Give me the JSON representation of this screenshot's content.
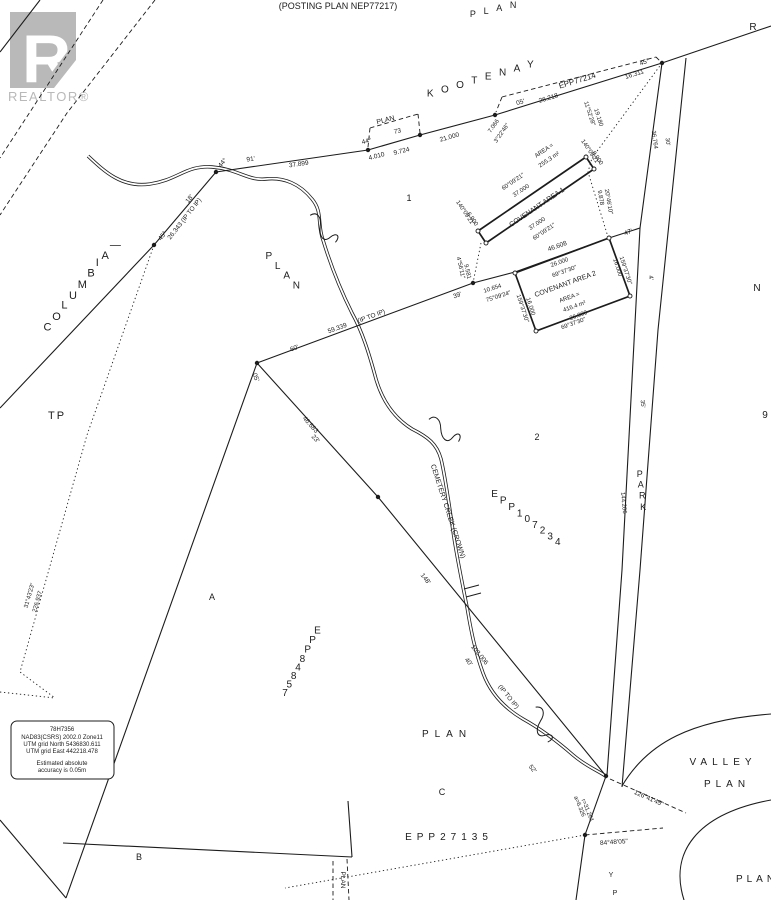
{
  "ink": "#1c1c1c",
  "watermark": {
    "r": "R",
    "brand": "REALTOR®",
    "gray": "#b9b9b9"
  },
  "header": {
    "posting_plan": "(POSTING PLAN NEP77217)",
    "plan": "PLAN"
  },
  "streets": {
    "kootenay": "KOOTENAY",
    "columbia": "COLUMBIA—",
    "park": "PARK",
    "valley": "VALLEY",
    "valley_plan": "PLAN",
    "street_letter_1": "Y",
    "street_letter_2": "P"
  },
  "plan_numbers": {
    "epp77214": "EPP77214",
    "epp107234": "EPP107234",
    "epp84857": "EPP84857",
    "epp27135": "EPP27135"
  },
  "lots": {
    "lot1": "1",
    "lot2": "2",
    "lotA": "A",
    "lotB": "B",
    "lotC": "C",
    "tp": "TP",
    "n": "N",
    "nine": "9",
    "r": "R",
    "plan_left": "PLAN",
    "plan_mid": "PLAN",
    "plan_strip": "PLAN",
    "plan_bottom_right": "PLAN"
  },
  "creek": {
    "name": "CEMETERY CREEK (CROWN)"
  },
  "covenant1": {
    "title": "COVENANT AREA 1",
    "area_label": "AREA =",
    "area_value": "255.3 m²"
  },
  "covenant2": {
    "title": "COVENANT AREA 2",
    "area_label": "AREA =",
    "area_value": "416.4 m²"
  },
  "dims": {
    "d91": "91'",
    "d37899": "37.899",
    "d44a": "44°",
    "d18": "18'",
    "d26343": "26.343 (IP TO IP)",
    "d45a": "45°",
    "plan_bracket": "PLAN",
    "d73": "73",
    "d44b": "44°",
    "d4010": "4.010",
    "d9724": "9.724",
    "d21000": "21.000",
    "d7066": "7.066",
    "d32246": "3°22'46\"",
    "d05": "05'",
    "d26218": "26.218",
    "d16311": "16.311",
    "d45b": "45°",
    "d36764": "36.764",
    "d30": "30'",
    "d1152": "11°52'28\"",
    "d19180": "19.180",
    "d60921a": "60°09'21\"",
    "d37000a": "37.000",
    "d37000b": "37.000",
    "d60921b": "60°09'21\"",
    "d140a": "140°09'21\"",
    "d6900a": "6.900",
    "d140b": "140°09'21\"",
    "d6900b": "6.900",
    "d456": "4°56'11\"",
    "d9581": "9.581",
    "d9878": "9.878",
    "d2046": "20°46'10\"",
    "d60": "60'",
    "d59339": "59.339",
    "dip1": "(IP TO IP)",
    "d39": "39'",
    "d05b": "05'",
    "d10654": "10.654",
    "d75924": "75°09'24\"",
    "d46608": "46.608",
    "d47": "47'",
    "d26000a": "26.000",
    "d69373a": "69°37'30\"",
    "d26000b": "26.000",
    "d69373b": "69°37'30\"",
    "d16000a": "16.000",
    "d159a": "159°37'30\"",
    "d16000b": "16.000",
    "d159b": "159°37'30\"",
    "d4": "4'",
    "d144206": "144.206",
    "d35": "35'",
    "d31432": "31°43'23\"",
    "d226937": "226.937",
    "d46683": "46.683",
    "d23": "23'",
    "d148": "148'",
    "d103006": "103.006",
    "d40": "40'",
    "dip2": "(IP TO IP)",
    "d52": "52'",
    "da6326": "a=6.326",
    "dr31261": "r=31.261",
    "d12641": "126°41'45\"",
    "d84480": "84°48'05\""
  },
  "info_box": {
    "l1": "78H7356",
    "l2": "NAD83(CSRS) 2002.0 Zone11",
    "l3": "UTM grid North 5436830.611",
    "l4": "UTM grid East 442218.478",
    "l5": "Estimated absolute",
    "l6": "accuracy is 0.05m"
  }
}
